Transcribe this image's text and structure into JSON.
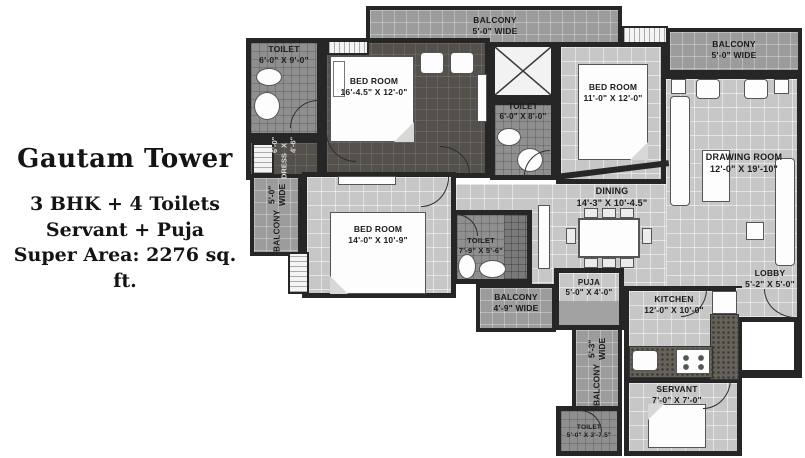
{
  "project": {
    "title": "Gautam Tower",
    "line1": "3 BHK + 4 Toilets",
    "line2": "Servant + Puja",
    "line3": "Super Area: 2276 sq. ft."
  },
  "rooms": {
    "balcony_top": {
      "name": "BALCONY",
      "dims": "5'-0\" WIDE"
    },
    "balcony_top_right": {
      "name": "BALCONY",
      "dims": "5'-0\" WIDE"
    },
    "toilet_master": {
      "name": "TOILET",
      "dims": "6'-0\" X 9'-0\""
    },
    "bedroom_master": {
      "name": "BED ROOM",
      "dims": "16'-4.5\" X 12'-0\""
    },
    "dress": {
      "name": "DRESS",
      "dims": "6'-0\" X 4'-6\""
    },
    "toilet_common": {
      "name": "TOILET",
      "dims": "6'-0\" X 8'-0\""
    },
    "bedroom_2": {
      "name": "BED ROOM",
      "dims": "11'-0\" X 12'-0\""
    },
    "drawing_room": {
      "name": "DRAWING ROOM",
      "dims": "12'-0\" X 19'-10\""
    },
    "balcony_left": {
      "name": "BALCONY",
      "dims": "5'-0\" WIDE"
    },
    "bedroom_3": {
      "name": "BED ROOM",
      "dims": "14'-0\" X 10'-9\""
    },
    "toilet_3": {
      "name": "TOILET",
      "dims": "7'-9\" X 5'-6\""
    },
    "dining": {
      "name": "DINING",
      "dims": "14'-3\" X 10'-4.5\""
    },
    "balcony_mid": {
      "name": "BALCONY",
      "dims": "4'-9\" WIDE"
    },
    "puja": {
      "name": "PUJA",
      "dims": "5'-0\" X 4'-0\""
    },
    "kitchen": {
      "name": "KITCHEN",
      "dims": "12'-0\" X 10'-0\""
    },
    "lobby": {
      "name": "LOBBY",
      "dims": "5'-2\" X 5'-0\""
    },
    "balcony_bottom": {
      "name": "BALCONY",
      "dims": "5'-3\" WIDE"
    },
    "servant": {
      "name": "SERVANT",
      "dims": "7'-0\" X 7'-0\""
    },
    "toilet_servant": {
      "name": "TOILET",
      "dims": "5'-0\" X 3'-7.5\""
    }
  },
  "colors": {
    "wall": "#262626",
    "floor_light": "#c7c7c7",
    "floor_dark": "#54504b",
    "balcony": "#9c9c9c",
    "toilet_floor": "#8f8f8f",
    "text": "#1b1b1b"
  }
}
